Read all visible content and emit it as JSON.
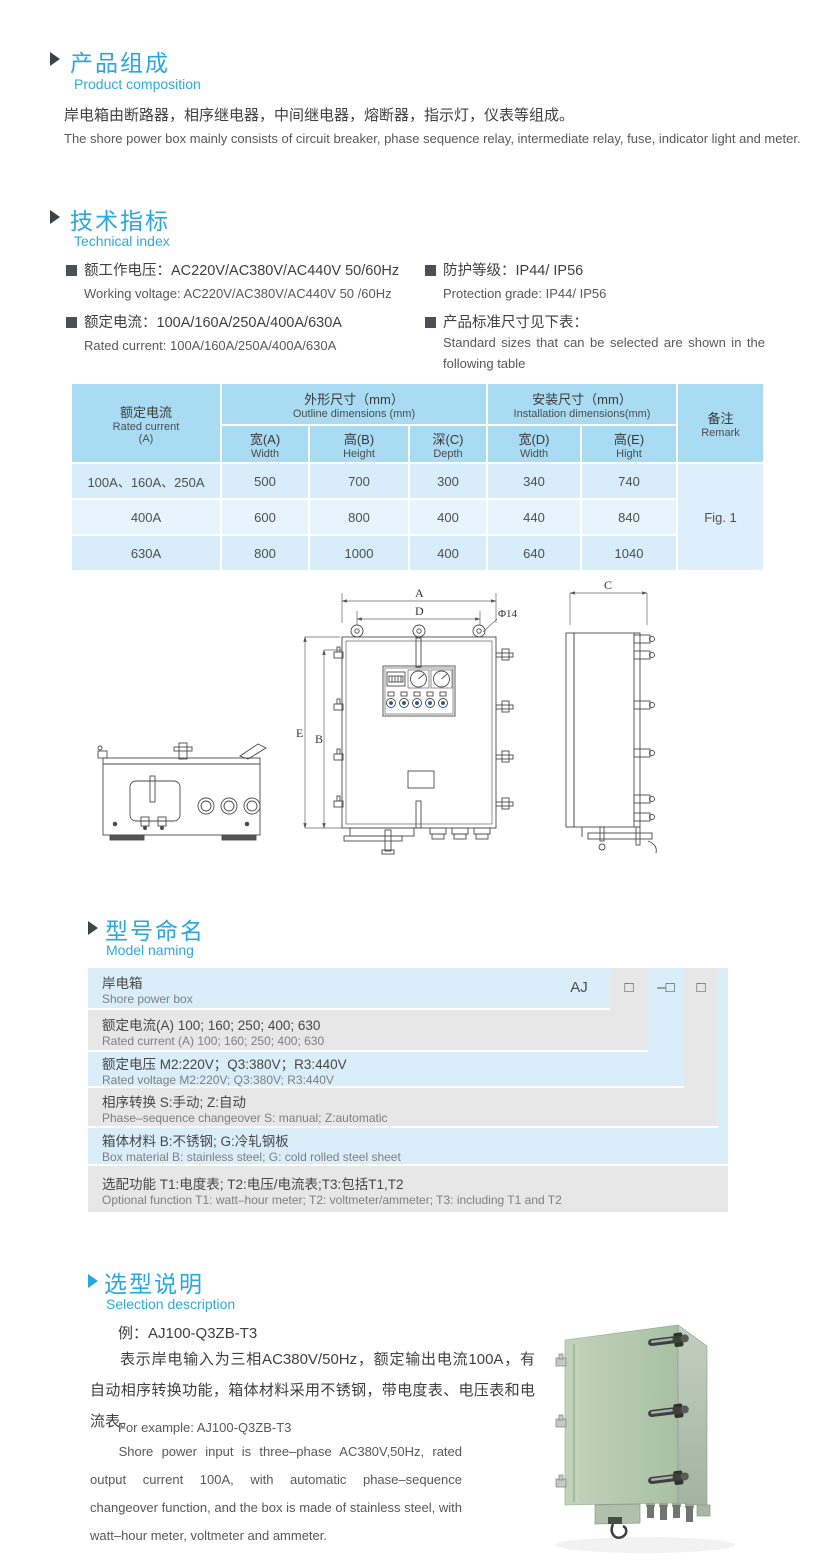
{
  "composition": {
    "title_zh": "产品组成",
    "title_en": "Product  composition",
    "text_zh": "岸电箱由断路器，相序继电器，中间继电器，熔断器，指示灯，仪表等组成。",
    "text_en": "The shore power box mainly consists of circuit breaker, phase sequence relay, intermediate relay, fuse, indicator light and meter."
  },
  "technical": {
    "title_zh": "技术指标",
    "title_en": "Technical index",
    "bullets": [
      {
        "zh": "额工作电压：AC220V/AC380V/AC440V  50/60Hz",
        "en": "Working voltage: AC220V/AC380V/AC440V 50 /60Hz"
      },
      {
        "zh": "额定电流：100A/160A/250A/400A/630A",
        "en": "Rated current: 100A/160A/250A/400A/630A"
      },
      {
        "zh": "防护等级：IP44/ IP56",
        "en": "Protection grade: IP44/ IP56"
      },
      {
        "zh": "产品标准尺寸见下表：",
        "en": "Standard sizes that can be selected are shown in the following table"
      }
    ]
  },
  "dim_table": {
    "col_current_zh": "额定电流",
    "col_current_en": "Rated current",
    "col_current_unit": "(A)",
    "group_outline_zh": "外形尺寸（mm）",
    "group_outline_en": "Outline dimensions (mm)",
    "group_install_zh": "安装尺寸（mm）",
    "group_install_en": "Installation dimensions(mm)",
    "remark_zh": "备注",
    "remark_en": "Remark",
    "sub_headers": [
      {
        "zh": "宽(A)",
        "en": "Width"
      },
      {
        "zh": "高(B)",
        "en": "Height"
      },
      {
        "zh": "深(C)",
        "en": "Depth"
      },
      {
        "zh": "宽(D)",
        "en": "Width"
      },
      {
        "zh": "高(E)",
        "en": "Hight"
      }
    ],
    "rows": [
      {
        "current": "100A、160A、250A",
        "values": [
          "500",
          "700",
          "300",
          "340",
          "740"
        ]
      },
      {
        "current": "400A",
        "values": [
          "600",
          "800",
          "400",
          "440",
          "840"
        ]
      },
      {
        "current": "630A",
        "values": [
          "800",
          "1000",
          "400",
          "640",
          "1040"
        ]
      }
    ],
    "remark_value": "Fig. 1"
  },
  "drawing": {
    "labels": {
      "a": "A",
      "b": "B",
      "c": "C",
      "d": "D",
      "e": "E",
      "hole": "Φ14"
    }
  },
  "model_naming": {
    "title_zh": "型号命名",
    "title_en": "Model naming",
    "code": {
      "prefix": "AJ",
      "box1": "□",
      "box2": "–□",
      "box3": "□"
    },
    "rows": [
      {
        "zh": "岸电箱",
        "en": "Shore power box"
      },
      {
        "zh": "额定电流(A)  100; 160; 250; 400; 630",
        "en": "Rated current (A) 100; 160; 250; 400; 630"
      },
      {
        "zh": "额定电压   M2:220V；Q3:380V；R3:440V",
        "en": "Rated voltage  M2:220V;  Q3:380V;  R3:440V"
      },
      {
        "zh": "相序转换  S:手动; Z:自动",
        "en": "Phase–sequence changeover  S: manual;  Z:automatic"
      },
      {
        "zh": "箱体材料    B:不锈钢;  G:冷轧钢板",
        "en": "Box material   B: stainless steel; G: cold rolled steel sheet"
      },
      {
        "zh": "选配功能      T1:电度表;  T2:电压/电流表;T3:包括T1,T2",
        "en": "Optional function  T1: watt–hour meter; T2: voltmeter/ammeter; T3: including T1 and T2"
      }
    ]
  },
  "selection": {
    "title_zh": "选型说明",
    "title_en": "Selection description",
    "example_zh": "例：AJ100-Q3ZB-T3",
    "para_zh": "表示岸电输入为三相AC380V/50Hz，额定输出电流100A，有自动相序转换功能，箱体材料采用不锈钢，带电度表、电压表和电流表。",
    "example_en": "For example: AJ100-Q3ZB-T3",
    "para_en": "Shore power input is three–phase AC380V,50Hz, rated output current 100A, with automatic phase–sequence changeover function, and the box is made of stainless steel, with watt–hour meter, voltmeter and ammeter."
  },
  "colors": {
    "accent_blue": "#29a7e0",
    "table_header_blue": "#a9dbf3",
    "band_blue": "#d9eef9",
    "band_gray": "#e7e7e7",
    "photo_green": "#b6cab1"
  }
}
